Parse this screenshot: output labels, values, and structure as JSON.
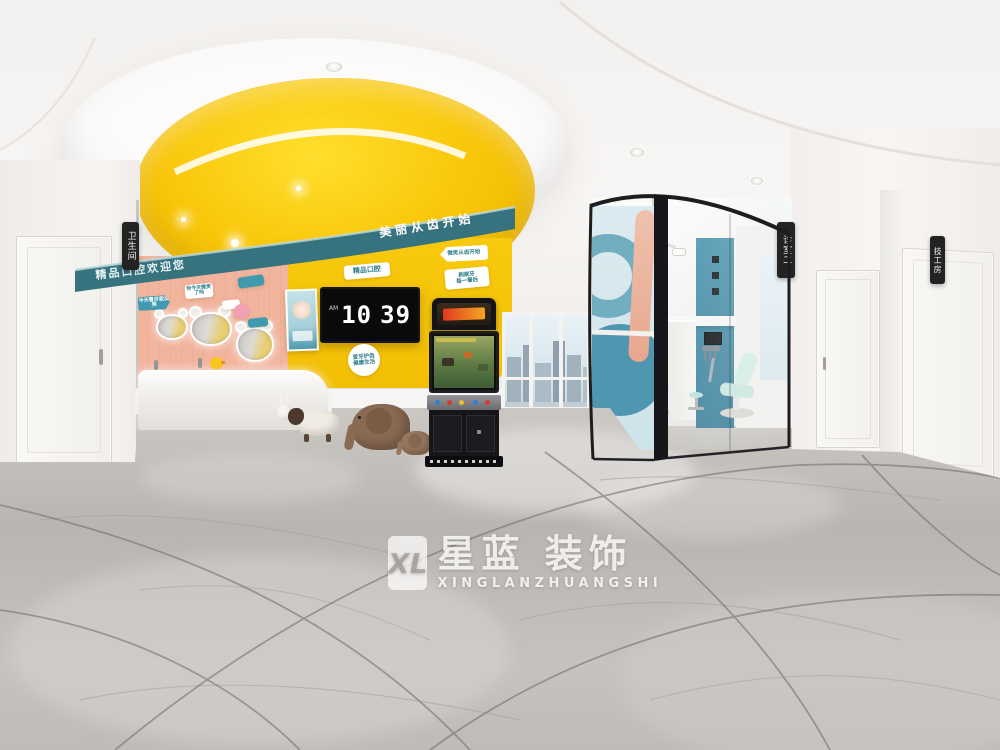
{
  "meta": {
    "description": "360-degree panorama render of a children's dental clinic interior with reception, arcade machine, glass treatment room and marble floor"
  },
  "watermark": {
    "logo": "XL",
    "title": "星蓝 装饰",
    "subtitle": "XINGLANZHUANGSHI"
  },
  "signs": {
    "restroom": "卫生间",
    "consult_room_2": "诊室二",
    "lab_room": "技工房"
  },
  "tv": {
    "clock_hour": "10",
    "clock_minute": "39",
    "meridiem": "AM"
  },
  "band": {
    "left": "精品口腔欢迎您",
    "right": "美丽从齿开始"
  },
  "badges": {
    "boutique": "精品口腔",
    "smile_arrow": "微笑从齿开始",
    "brush_line1": "刷刷牙",
    "brush_line2": "每一餐后",
    "round_line1": "爱牙护齿",
    "round_line2": "健康生活",
    "pink_arrow": "今天看牙我没哭",
    "pink_smile": "你今天微笑了吗"
  },
  "colors": {
    "accent_yellow": "#f6c50b",
    "band_teal": "#37737f",
    "wall_pink": "#f0b39c",
    "glass_blue": "#4a93ad",
    "chair_mint": "#cde8df",
    "floor_gray": "#bdb9b5"
  }
}
